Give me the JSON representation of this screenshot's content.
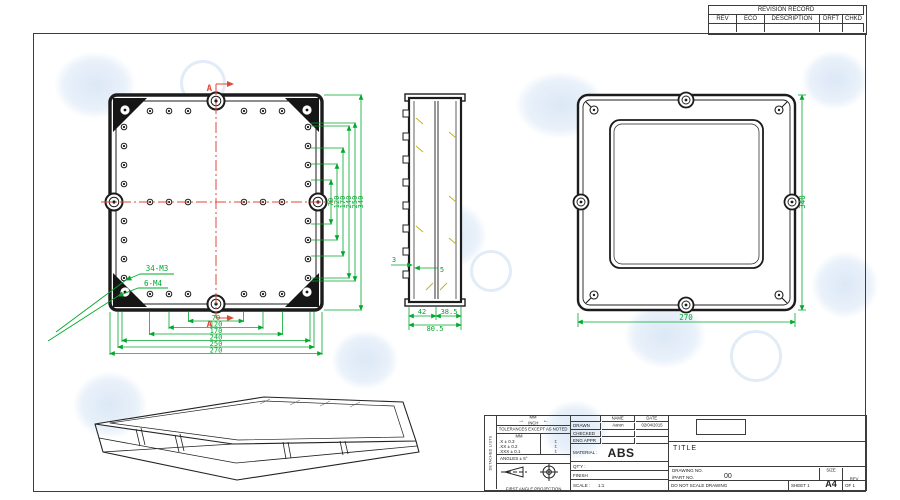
{
  "colors": {
    "line": "#1c1c1c",
    "dimension_green": "#00a82d",
    "centerline_red": "#e0463a",
    "aux_yellow": "#c2b31f",
    "watermark_blue": "#dce8f6"
  },
  "revision_table": {
    "title": "REVISION RECORD",
    "columns": [
      "REV",
      "ECO",
      "DESCRIPTION",
      "DRFT",
      "CHKD"
    ]
  },
  "front_view": {
    "section_label_top": "A",
    "section_label_bottom": "A",
    "thread_note_1": "34-M3",
    "thread_note_2": "6-M4",
    "bottom_dims": [
      "70",
      "120",
      "170",
      "240",
      "250",
      "270"
    ],
    "right_dims": [
      "70",
      "120",
      "170",
      "240",
      "250",
      "340"
    ]
  },
  "side_view": {
    "dim_3": "3",
    "dim_5": "5",
    "dim_42": "42",
    "dim_385": "38.5",
    "dim_805": "80.5"
  },
  "back_view": {
    "dim_width": "270",
    "dim_height": "340"
  },
  "title_block": {
    "side_strip": "DETACHED LISTS",
    "units_top": "MM",
    "units_bottom": "INCH",
    "tol_note": "TOLERANCES EXCEPT AS NOTED",
    "tol_header": "MM",
    "tol_rows": [
      [
        ".X ± 0.3",
        "±"
      ],
      [
        ".XX ± 0.2",
        "±"
      ],
      [
        ".XXX ± 0.1",
        "±"
      ]
    ],
    "angles": "ANGLES ± 5°",
    "projection": "FIRST ANGLE PROJECTION",
    "name_header": "NAME",
    "date_header": "DATE",
    "drawn_label": "DRAWN",
    "drawn_name": "Aaron",
    "drawn_date": "02/04/2015",
    "checked_label": "CHECKED",
    "eng_appr_label": "ENG APPR",
    "material_label": "MATERIAL :",
    "material_value": "ABS",
    "qty_label": "QT'Y :",
    "finish_label": "FINISH",
    "scale_label": "SCALE :",
    "scale_value": "1:1",
    "title_label": "TITLE",
    "drawing_no_label": "DRAWING NO.",
    "part_no_label": "/PART NO.",
    "part_no_value": "00",
    "size_label": "SIZE",
    "size_value": "A4",
    "rev_label": "REV",
    "do_not_scale": "DO NOT SCALE DRAWING",
    "sheet_label": "SHEET 1",
    "of_label": "OF 1"
  }
}
